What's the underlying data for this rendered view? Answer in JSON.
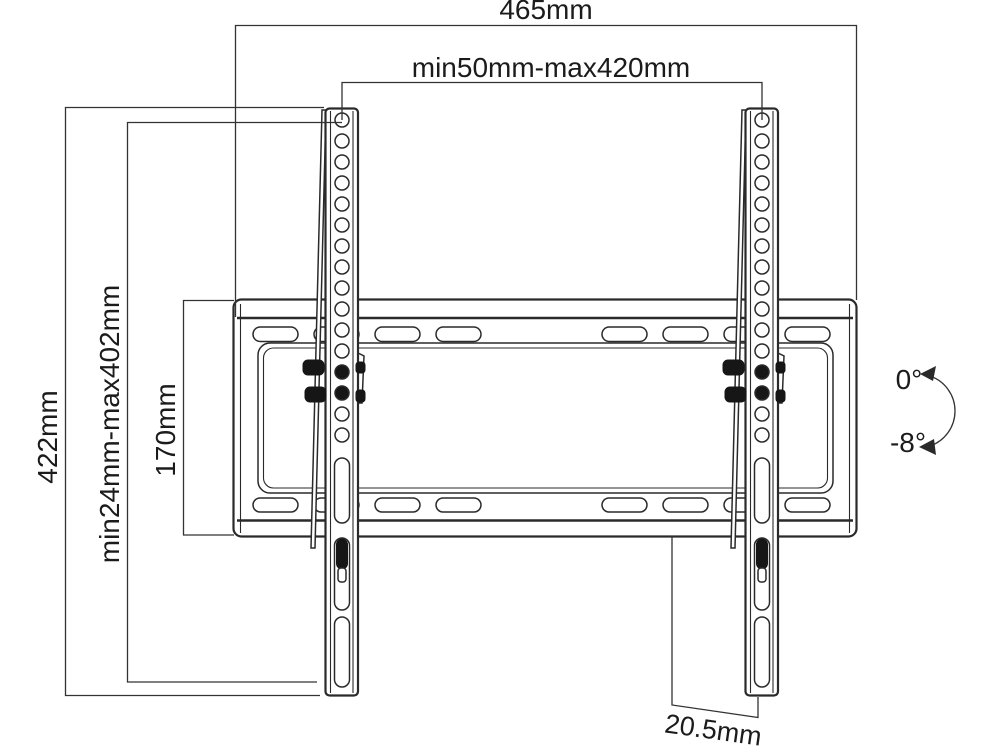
{
  "drawing": {
    "labels": {
      "width_total": "465mm",
      "hole_span_horizontal": "min50mm-max420mm",
      "height_total": "422mm",
      "hole_span_vertical": "min24mm-max402mm",
      "plate_height": "170mm",
      "bottom_depth": "20.5mm",
      "tilt_upper": "0°",
      "tilt_lower": "-8°"
    },
    "colors": {
      "line": "#2a2a2a",
      "background": "#ffffff"
    }
  }
}
